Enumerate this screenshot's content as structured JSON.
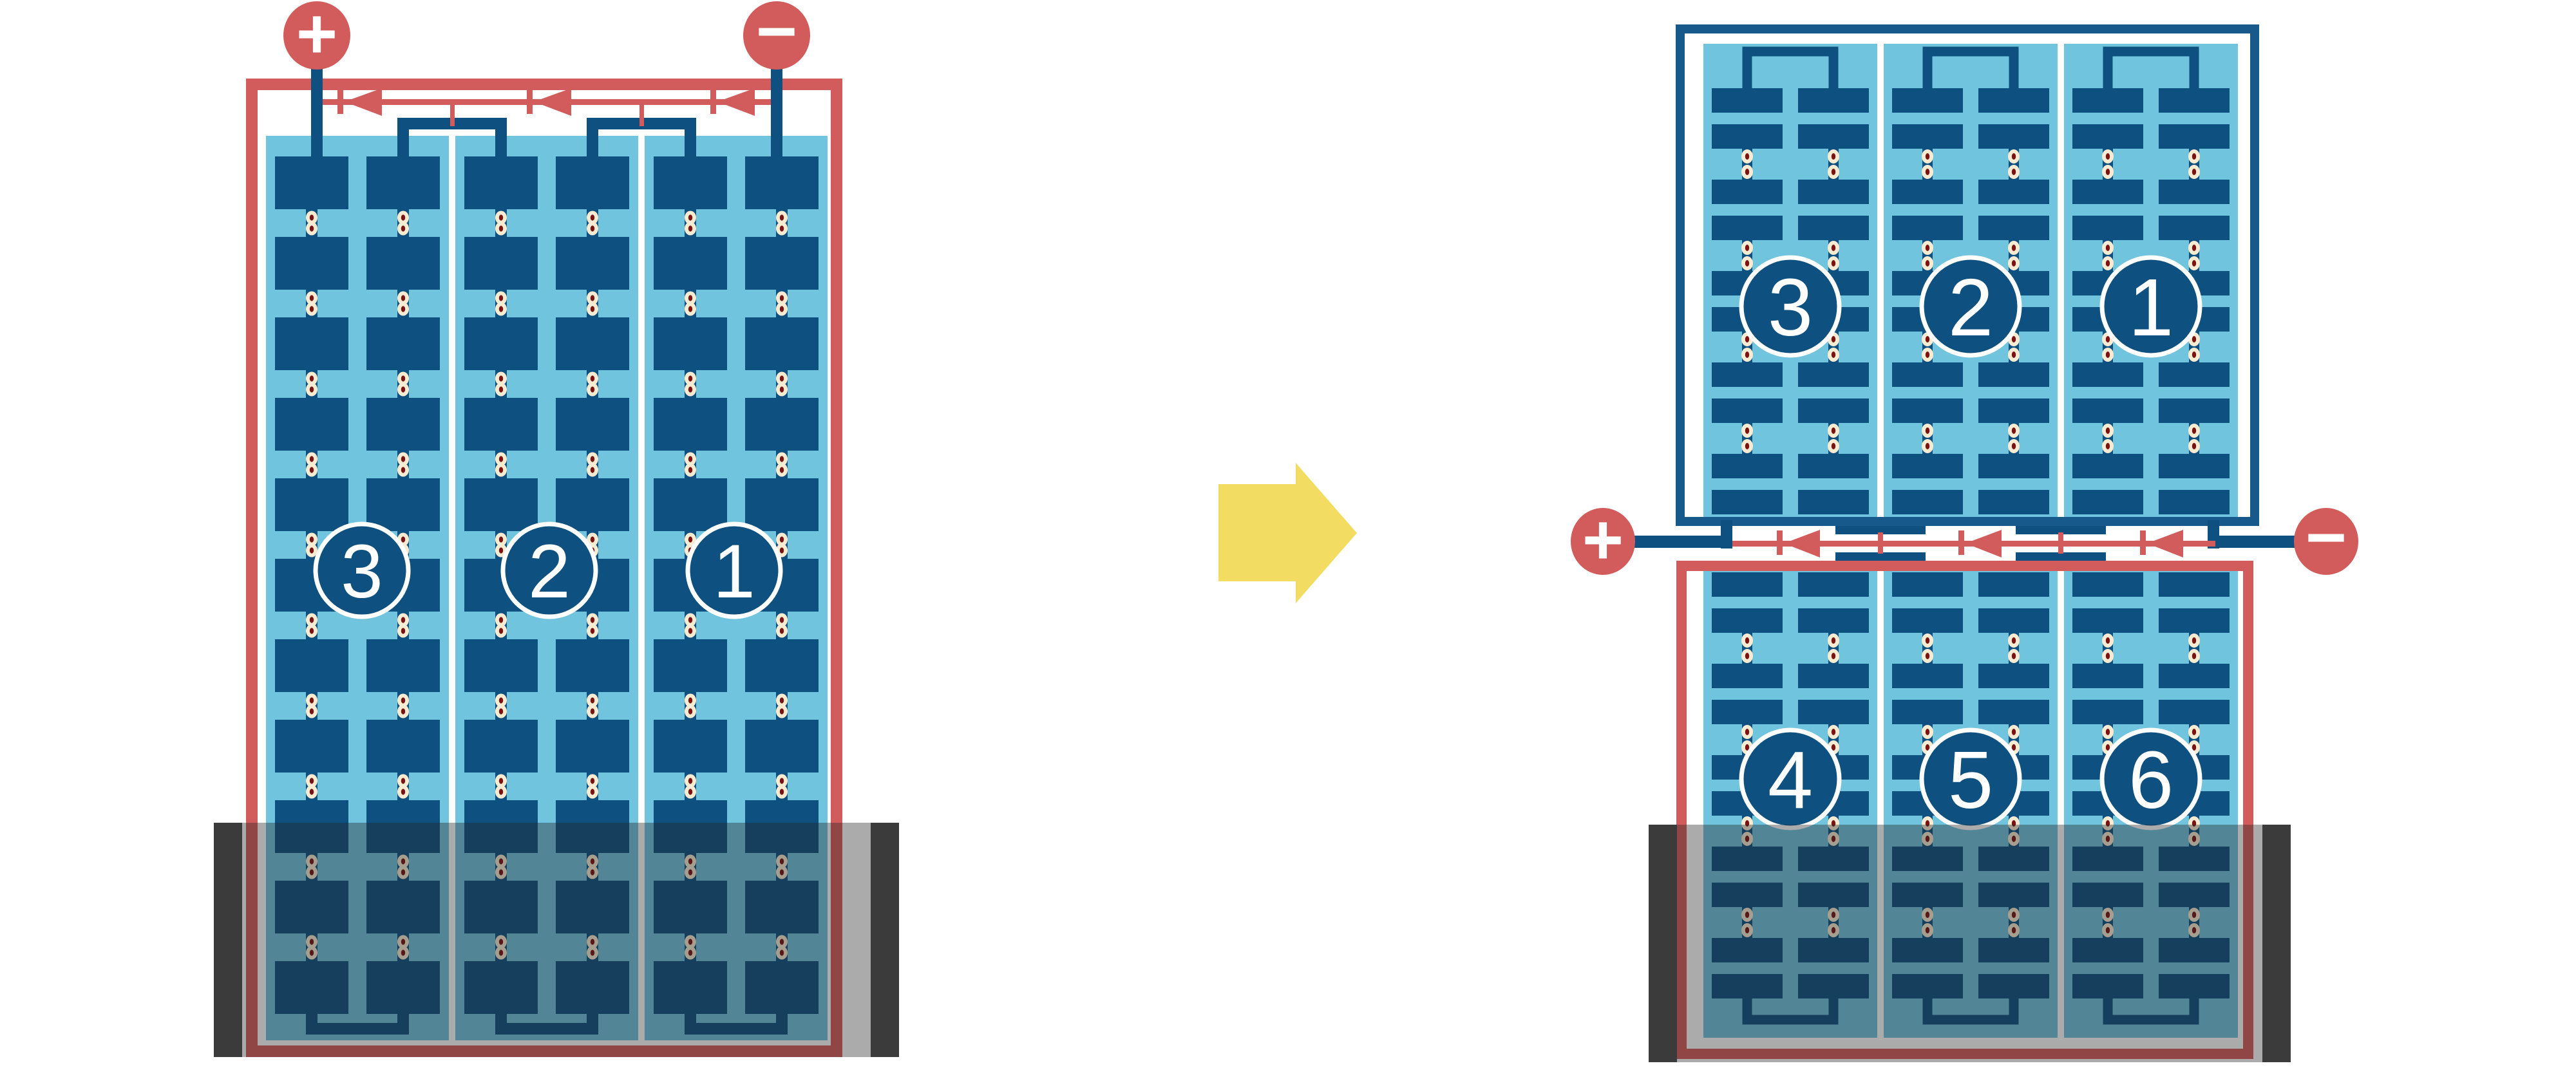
{
  "diagram_type": "solar-panel-wiring-comparison",
  "left_panel": {
    "description": "full-size panel, three cell strings in series, flooded at bottom",
    "strings": [
      {
        "label": "3"
      },
      {
        "label": "2"
      },
      {
        "label": "1"
      }
    ],
    "terminals": {
      "positive": "+",
      "negative": "−"
    },
    "bypass_diodes_count": 3
  },
  "transition": {
    "arrow": "→"
  },
  "right_top_panel": {
    "description": "upper half of half-cut panel, unshaded",
    "strings": [
      {
        "label": "3"
      },
      {
        "label": "2"
      },
      {
        "label": "1"
      }
    ]
  },
  "junction": {
    "terminals": {
      "positive": "+",
      "negative": "−"
    },
    "bypass_diodes_count": 3
  },
  "right_bottom_panel": {
    "description": "lower half of half-cut panel, flooded at bottom",
    "strings": [
      {
        "label": "4"
      },
      {
        "label": "5"
      },
      {
        "label": "6"
      }
    ]
  },
  "colors": {
    "red": "#d25c5b",
    "navy": "#0e5180",
    "navy_frame": "#17598b",
    "light_blue": "#70c4de",
    "cream_dot": "#f7ecd2",
    "maroon_dot": "#7a1212",
    "yellow_arrow": "#f3dc62",
    "flood_overlay": "rgba(35,35,35,0.38)",
    "flood_cap": "#3b3b3b",
    "background": "#ffffff"
  }
}
